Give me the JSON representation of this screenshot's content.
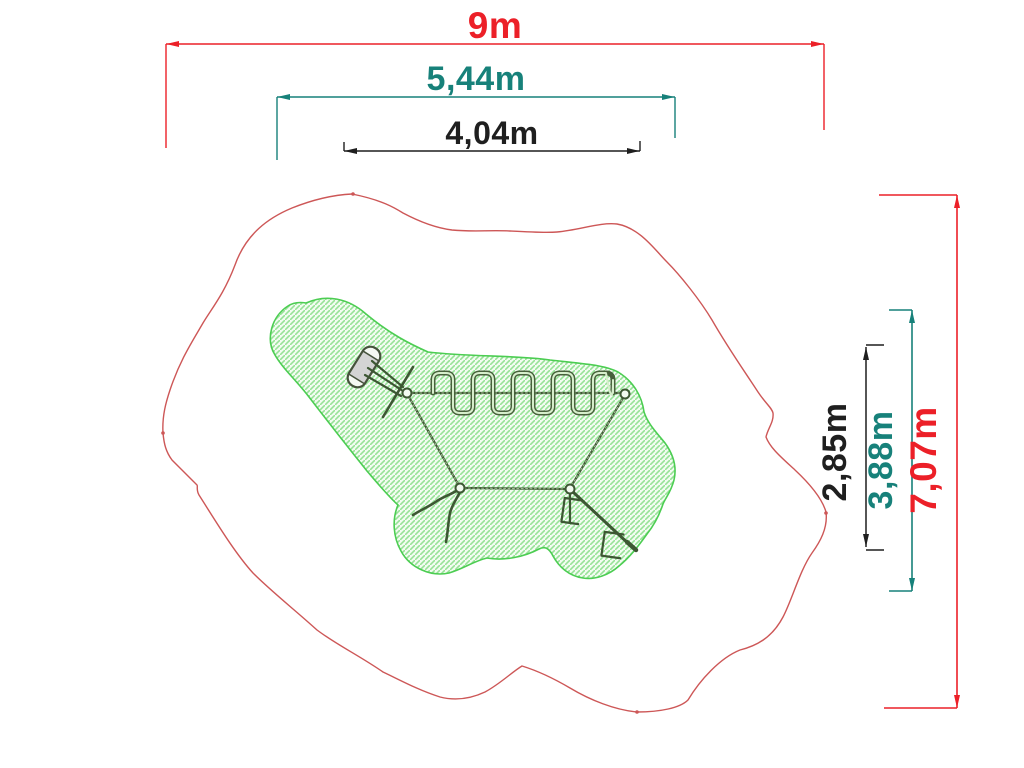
{
  "drawing": {
    "title": "playground-equipment-plan-view",
    "dims": {
      "top": [
        {
          "id": "overall-width",
          "label": "9m",
          "value": 9.0,
          "unit": "m",
          "color": "#ec2028"
        },
        {
          "id": "safety-width",
          "label": "5,44m",
          "value": 5.44,
          "unit": "m",
          "color": "#17817a"
        },
        {
          "id": "equipment-width",
          "label": "4,04m",
          "value": 4.04,
          "unit": "m",
          "color": "#1f1f1f"
        }
      ],
      "right": [
        {
          "id": "equipment-depth",
          "label": "2,85m",
          "value": 2.85,
          "unit": "m",
          "color": "#1f1f1f"
        },
        {
          "id": "safety-depth",
          "label": "3,88m",
          "value": 3.88,
          "unit": "m",
          "color": "#17817a"
        },
        {
          "id": "overall-depth",
          "label": "7,07m",
          "value": 7.07,
          "unit": "m",
          "color": "#ec2028"
        }
      ]
    },
    "colors": {
      "dimension_red": "#ec2028",
      "dimension_teal": "#17817a",
      "dimension_black": "#1f1f1f",
      "safety_outline_red": "#cd5757",
      "footprint_green": "#4ccd52",
      "hatch_green": "#97e297",
      "equipment_dark_green": "#3d5733",
      "pad_grey": "#d4d4d4"
    }
  }
}
